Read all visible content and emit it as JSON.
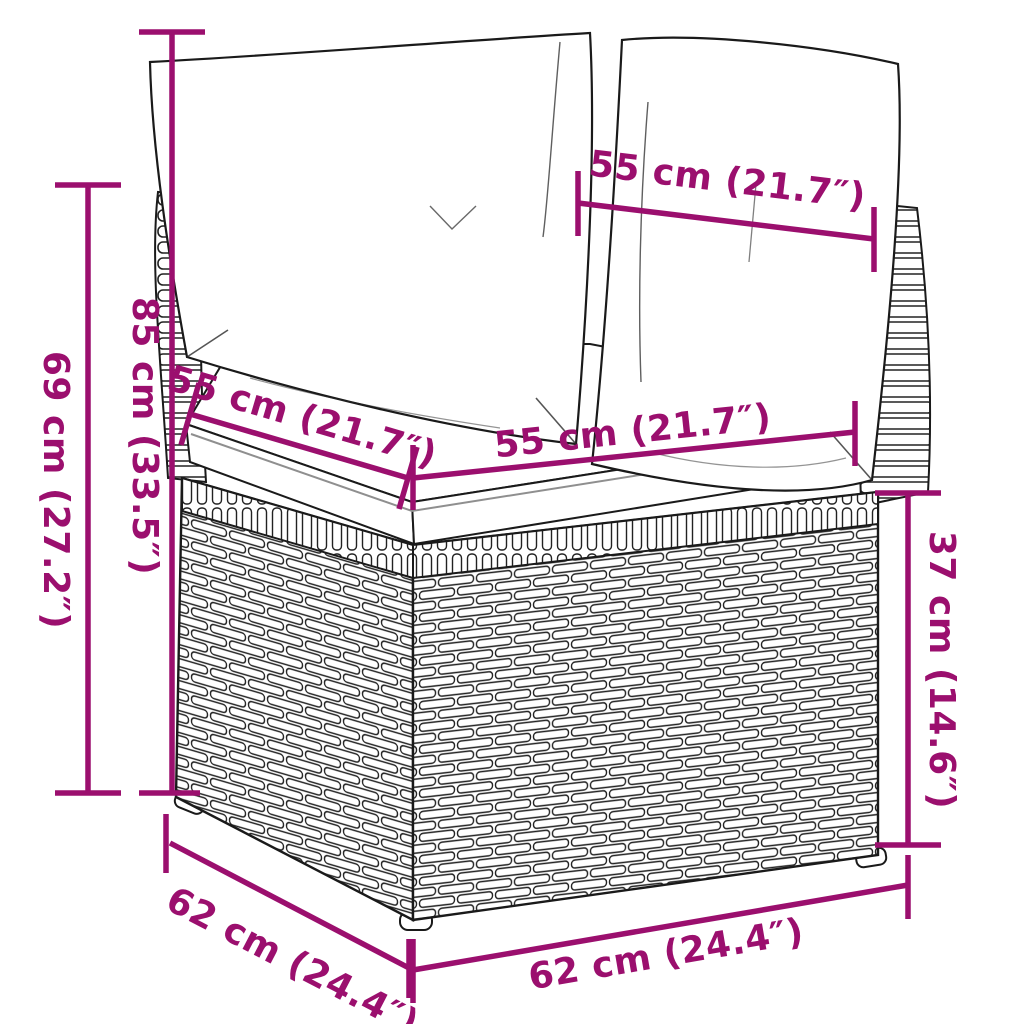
{
  "figure_title": "corner-sofa-dimension-diagram",
  "colors": {
    "dimension_accent": "#9B0F6E",
    "outline": "#1a1a1a",
    "fill": "#ffffff"
  },
  "dimensions": {
    "back_width_top": "55 cm (21.7″)",
    "height_total": "85 cm (33.5″)",
    "height_back": "69 cm (27.2″)",
    "seat_depth_upper": "55 cm (21.7″)",
    "seat_width_upper": "55 cm (21.7″)",
    "base_height": "37 cm (14.6″)",
    "base_depth": "62 cm (24.4″)",
    "base_width": "62 cm (24.4″)"
  }
}
